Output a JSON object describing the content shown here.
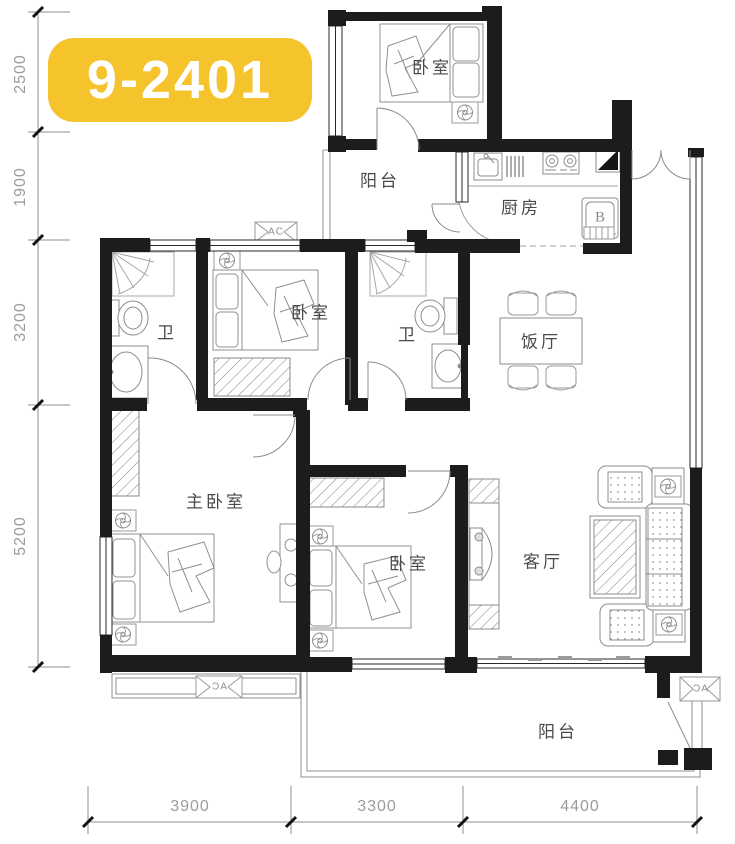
{
  "unit_badge": {
    "label": "9-2401"
  },
  "dimensions": {
    "left": [
      "2500",
      "1900",
      "3200",
      "5200"
    ],
    "bottom": [
      "3900",
      "3300",
      "4400"
    ]
  },
  "rooms": {
    "bedroom_top": "卧室",
    "balcony_top": "阳台",
    "kitchen": "厨房",
    "bath_1": "卫",
    "bedroom_mid": "卧室",
    "bath_2": "卫",
    "dining": "饭厅",
    "master_bedroom": "主卧室",
    "bedroom_bottom": "卧室",
    "living": "客厅",
    "balcony_bottom": "阳台"
  },
  "labels": {
    "fridge": "B",
    "ac": "AC"
  },
  "colors": {
    "badge_bg": "#F5C32C",
    "badge_text": "#FFFFFF",
    "wall": "#1C1C1C",
    "furniture_line": "#909090",
    "dim_text": "#9C9C9C"
  }
}
